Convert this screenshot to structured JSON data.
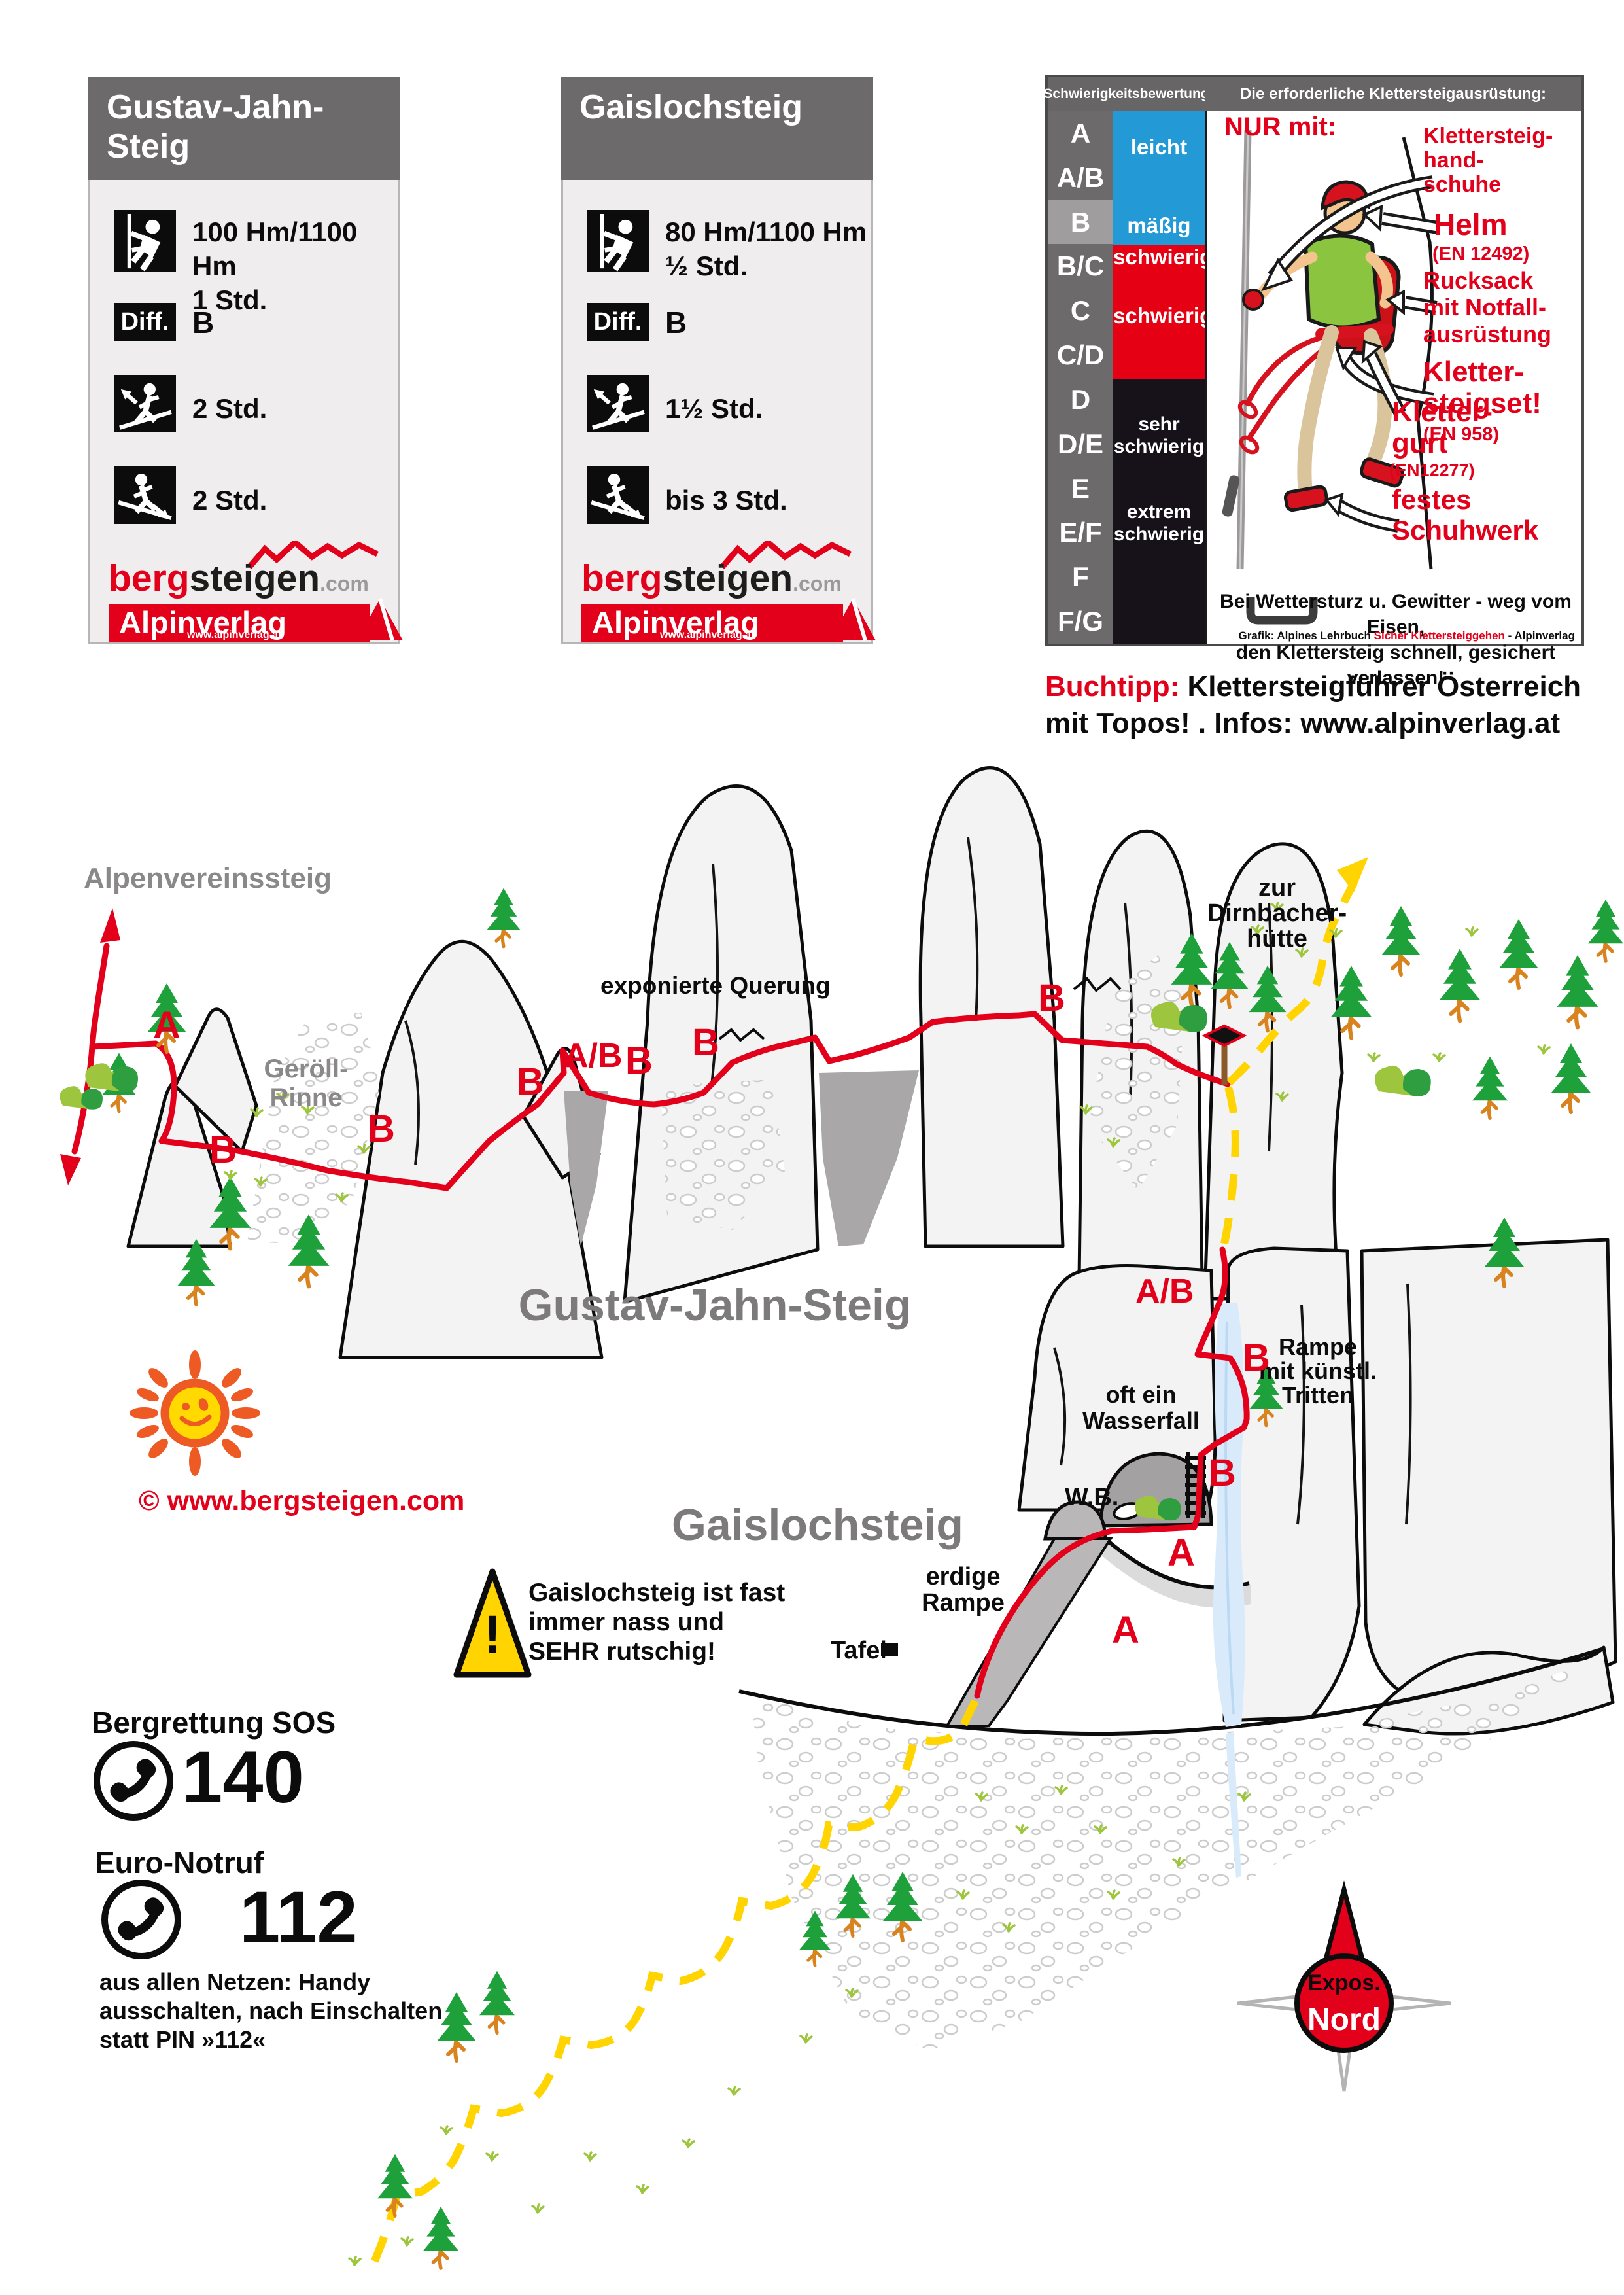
{
  "cards": [
    {
      "title": "Gustav-Jahn-\nSteig",
      "stats": [
        {
          "text": "100 Hm/1100 Hm\n1 Std."
        },
        {
          "box_label": "Diff.",
          "text": "B"
        },
        {
          "text": "2 Std."
        },
        {
          "text": "2 Std."
        }
      ]
    },
    {
      "title": "Gaislochsteig",
      "stats": [
        {
          "text": "80 Hm/1100 Hm\n½ Std."
        },
        {
          "box_label": "Diff.",
          "text": "B"
        },
        {
          "text": "1½ Std."
        },
        {
          "text": "bis 3 Std."
        }
      ]
    }
  ],
  "logos": {
    "bergsteigen": {
      "part1": "berg",
      "part2": "steigen",
      "part3": ".com"
    },
    "alpinverlag": {
      "name": "Alpinverlag",
      "url": "www.alpinverlag.at"
    }
  },
  "difficulty_panel": {
    "header_left": "Schwierigkeitsbewertung",
    "header_right": "Die erforderliche Klettersteigausrüstung:",
    "grades": [
      "A",
      "A/B",
      "B",
      "B/C",
      "C",
      "C/D",
      "D",
      "D/E",
      "E",
      "E/F",
      "F",
      "F/G"
    ],
    "highlighted_grade": "B",
    "scale": {
      "blue_top": "leicht",
      "blue_bottom": "mäßig",
      "red_top": "schwierig",
      "red_mid": "schwierig",
      "black_top": "sehr\nschwierig",
      "black_mid": "extrem\nschwierig"
    },
    "equipment": {
      "nur_mit": "NUR mit:",
      "labels": [
        {
          "text": "Klettersteig-\nhand-\nschuhe",
          "sub": ""
        },
        {
          "text": "Helm",
          "sub": "(EN 12492)"
        },
        {
          "text": "Rucksack\nmit Notfall-\nausrüstung",
          "sub": ""
        },
        {
          "text": "Kletter-\nsteigset!",
          "sub": "(EN 958)"
        },
        {
          "text": "Kletter-\ngurt",
          "sub": "(EN12277)"
        },
        {
          "text": "festes\nSchuhwerk",
          "sub": ""
        }
      ],
      "storm_warning": "Bei Wettersturz u. Gewitter - weg vom Eisen,\nden Klettersteig schnell, gesichert verlassen!",
      "credit_prefix": "Grafik: Alpines Lehrbuch ",
      "credit_highlight": "Sicher Klettersteiggehen",
      "credit_suffix": " - Alpinverlag"
    }
  },
  "buchtipp": {
    "label": "Buchtipp:",
    "line1_rest": "Klettersteigführer Österreich",
    "line2": "mit Topos! . Infos: www.alpinverlag.at"
  },
  "map": {
    "titles": {
      "gustav": "Gustav-Jahn-Steig",
      "gaisloch": "Gaislochsteig"
    },
    "labels": {
      "alpenvereinssteig": "Alpenvereinssteig",
      "geroell_rinne": "Geröll-\nRinne",
      "exponierte_querung": "exponierte Querung",
      "dirnbacherhuette": "zur\nDirnbacher-\nhütte",
      "oft_ein_wasserfall": "oft ein\nWasserfall",
      "wb": "W.B.",
      "rampe": "Rampe\nmit künstl.\nTritten",
      "erdige_rampe": "erdige\nRampe",
      "tafel": "Tafel"
    },
    "route_grades": [
      {
        "text": "A"
      },
      {
        "text": "B"
      },
      {
        "text": "B"
      },
      {
        "text": "B"
      },
      {
        "text": "A/B"
      },
      {
        "text": "B"
      },
      {
        "text": "B"
      },
      {
        "text": "B"
      },
      {
        "text": "A/B"
      },
      {
        "text": "B"
      },
      {
        "text": "B"
      },
      {
        "text": "A"
      },
      {
        "text": "A"
      }
    ],
    "hazard": {
      "mark": "!",
      "text": "Gaislochsteig ist fast\nimmer nass und\nSEHR rutschig!"
    },
    "copyright": "© www.bergsteigen.com",
    "compass": {
      "top": "Expos.",
      "bottom": "Nord"
    }
  },
  "emergency": {
    "sos_title": "Bergrettung SOS",
    "sos_number": "140",
    "euro_title": "Euro-Notruf",
    "euro_number": "112",
    "note": "aus allen Netzen: Handy\nausschalten, nach Einschalten\nstatt PIN »112«"
  },
  "colors": {
    "accent_red": "#e2001a",
    "scale_blue": "#2399d6",
    "scale_red": "#e60013",
    "scale_black": "#17121a",
    "path_yellow": "#ffd400",
    "map_title_gray": "#7c7a7b",
    "panel_gray": "#6d6a6b"
  }
}
